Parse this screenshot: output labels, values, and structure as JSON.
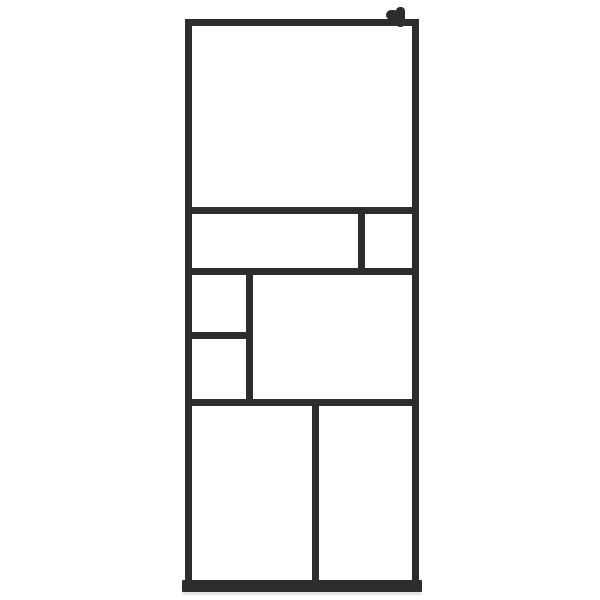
{
  "canvas": {
    "background_color": "#ffffff"
  },
  "colors": {
    "frame": "#2b2d2e",
    "glass": "#ffffff",
    "shadow": "#dedede"
  },
  "product": {
    "kind": "walk-in-shower-glass-screen",
    "frame_style": "black-grid-frame",
    "bracket": "top-right-wall-bracket",
    "panes": [
      {
        "id": "top-large"
      },
      {
        "id": "row2-wide"
      },
      {
        "id": "row2-right-small"
      },
      {
        "id": "row3-left-upper-small"
      },
      {
        "id": "row3-left-lower-small"
      },
      {
        "id": "row3-main-large"
      },
      {
        "id": "bottom-left"
      },
      {
        "id": "bottom-right"
      }
    ]
  }
}
